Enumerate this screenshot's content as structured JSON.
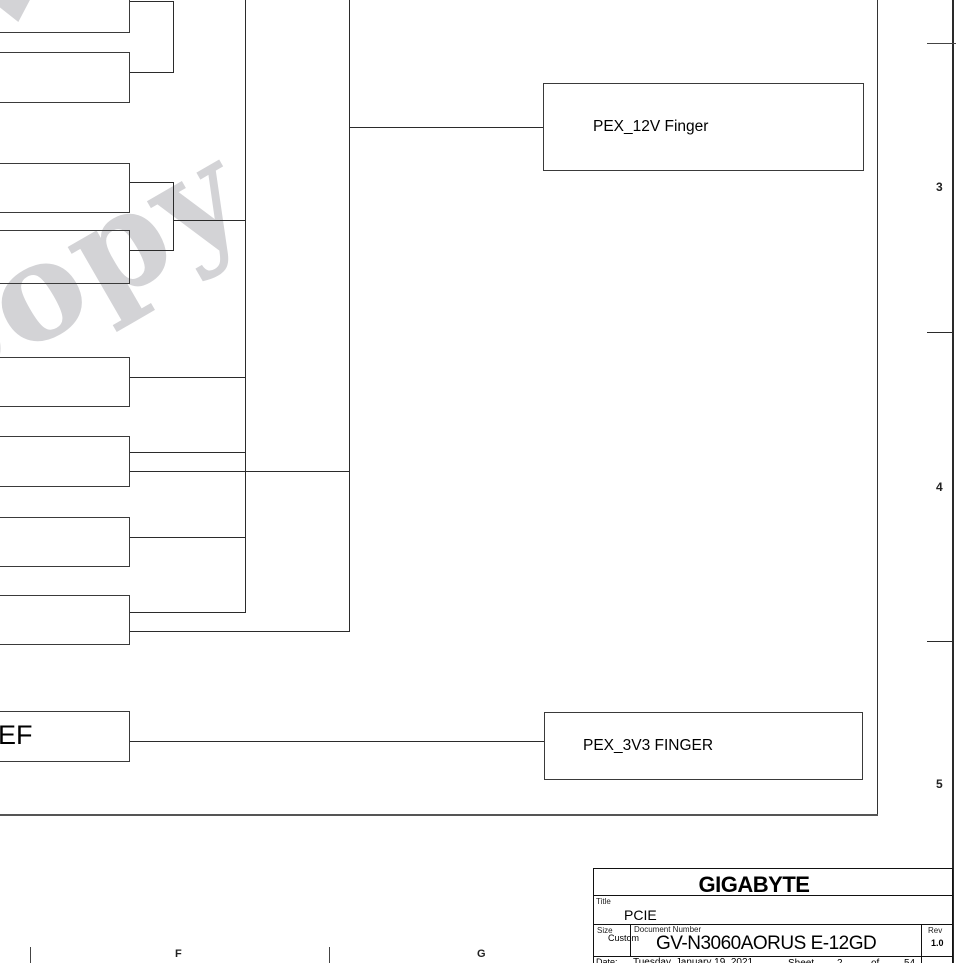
{
  "watermark": {
    "text": "Copy"
  },
  "diagram": {
    "pex_12v_label": "PEX_12V Finger",
    "pex_3v3_label": "PEX_3V3 FINGER",
    "ef_label": "EF"
  },
  "frame": {
    "zone_numbers": [
      "3",
      "4",
      "5"
    ],
    "zone_letters": [
      "F",
      "G"
    ]
  },
  "title_block": {
    "company": "GIGABYTE",
    "title_label": "Title",
    "title": "PCIE",
    "size_label": "Size",
    "size": "Custom",
    "doc_label": "Document Number",
    "doc_number": "GV-N3060AORUS E-12GD",
    "rev_label": "Rev",
    "rev": "1.0",
    "date_label": "Date:",
    "date": "Tuesday, January 19, 2021",
    "sheet_label": "Sheet",
    "sheet_number": "2",
    "of_label": "of",
    "sheet_total": "54"
  }
}
